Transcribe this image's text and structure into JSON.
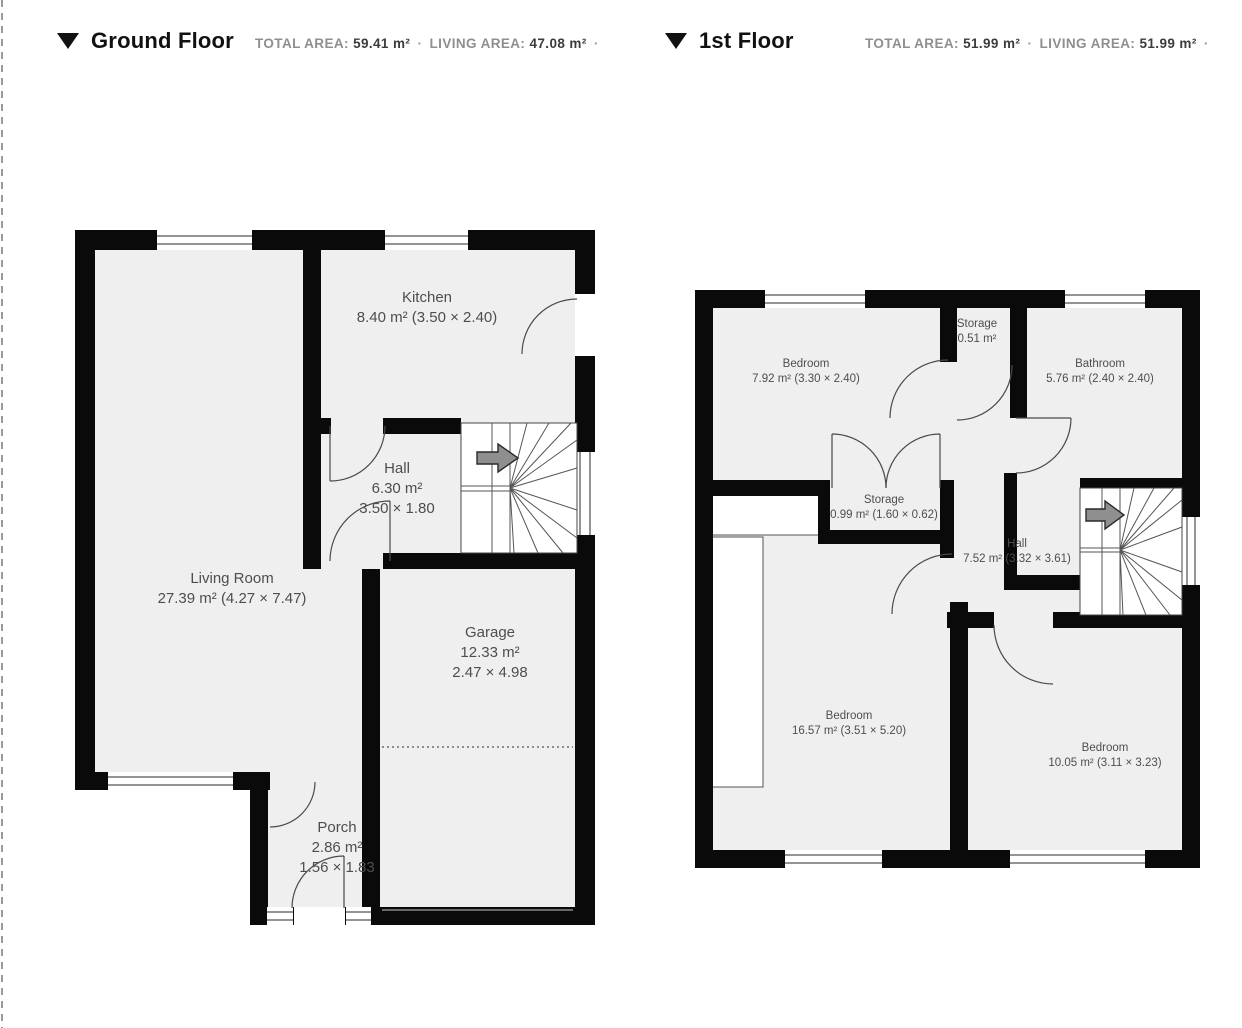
{
  "separator": "·",
  "floors": {
    "ground": {
      "title": "Ground Floor",
      "total_area_label": "TOTAL AREA:",
      "total_area_value": "59.41 m²",
      "living_area_label": "LIVING AREA:",
      "living_area_value": "47.08 m²",
      "rooms": [
        {
          "name": "Kitchen",
          "line2": "8.40 m² (3.50 × 2.40)"
        },
        {
          "name": "Hall",
          "line2": "6.30 m²",
          "line3": "3.50 × 1.80"
        },
        {
          "name": "Living Room",
          "line2": "27.39 m² (4.27 × 7.47)"
        },
        {
          "name": "Garage",
          "line2": "12.33 m²",
          "line3": "2.47 × 4.98"
        },
        {
          "name": "Porch",
          "line2": "2.86 m²",
          "line3": "1.56 × 1.83"
        }
      ]
    },
    "first": {
      "title": "1st Floor",
      "total_area_label": "TOTAL AREA:",
      "total_area_value": "51.99 m²",
      "living_area_label": "LIVING AREA:",
      "living_area_value": "51.99 m²",
      "rooms": [
        {
          "name": "Bedroom",
          "line2": "7.92 m² (3.30 × 2.40)"
        },
        {
          "name": "Storage",
          "line2": "0.51 m²"
        },
        {
          "name": "Bathroom",
          "line2": "5.76 m² (2.40 × 2.40)"
        },
        {
          "name": "Storage",
          "line2": "0.99 m² (1.60 × 0.62)"
        },
        {
          "name": "Hall",
          "line2": "7.52 m² (3.32 × 3.61)"
        },
        {
          "name": "Bedroom",
          "line2": "16.57 m² (3.51 × 5.20)"
        },
        {
          "name": "Bedroom",
          "line2": "10.05 m² (3.11 × 3.23)"
        }
      ]
    }
  },
  "icons": {
    "floor_toggle": "triangle-down-icon",
    "stairs_direction": "arrow-right-icon"
  },
  "colors": {
    "wall": "#0a0a0a",
    "floor_fill": "#efefef",
    "room_label_text": "#4e4e4e",
    "stats_label": "#8f8f8f",
    "stats_value": "#3c3c3c",
    "title_text": "#111111"
  }
}
